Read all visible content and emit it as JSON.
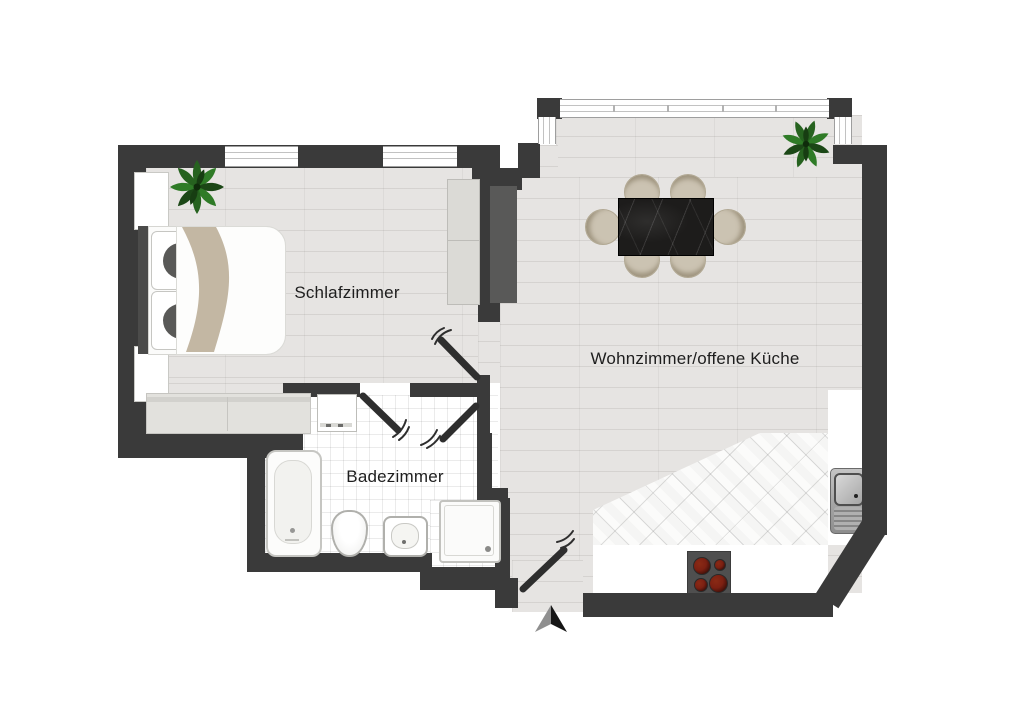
{
  "floorplan": {
    "type": "apartment-floor-plan",
    "rooms": [
      {
        "name": "schlafzimmer",
        "label": "Schlafzimmer"
      },
      {
        "name": "badezimmer",
        "label": "Badezimmer"
      },
      {
        "name": "wohnzimmer-offene-kueche",
        "label": "Wohnzimmer/offene Küche"
      }
    ],
    "colors": {
      "wall": "#3a3a3a",
      "floor_wood": "#e6e4e2",
      "floor_tile": "#ffffff",
      "plant_green": "#2e7a27",
      "blanket_beige": "#c3b7a3",
      "table_black": "#1d1c1b",
      "chair_tan": "#cbc3b2",
      "burner_red": "#7c2012",
      "door_swing": "#2e2e2e"
    },
    "icons": {
      "bedroom": [
        "plant-icon",
        "double-bed",
        "nightstand",
        "wardrobe",
        "sideboard"
      ],
      "bathroom": [
        "washing-machine",
        "bathtub",
        "toilet",
        "washbasin",
        "shower"
      ],
      "living_kitchen": [
        "dining-table",
        "dining-chair",
        "plant-icon",
        "stove",
        "kitchen-sink",
        "kitchen-counter"
      ],
      "symbols": [
        "window",
        "door-swing",
        "north-arrow"
      ]
    }
  }
}
